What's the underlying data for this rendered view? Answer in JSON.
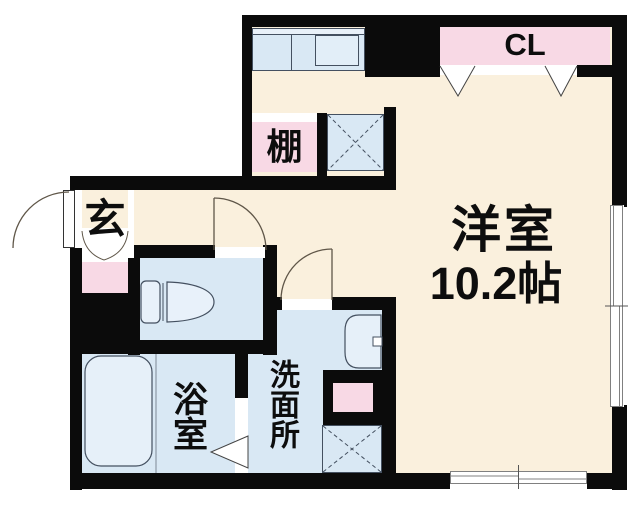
{
  "labels": {
    "closet": "CL",
    "shelf": "棚",
    "entrance": "玄",
    "main_room_name": "洋室",
    "main_room_size": "10.2帖",
    "bathroom": "浴室",
    "washroom": "洗面所"
  },
  "colors": {
    "wall": "#0b0b0b",
    "floor": "#faf0dd",
    "wet_area": "#d9e8f4",
    "accent_pink": "#f8d9e5",
    "fixture_fill": "#e7f0f9",
    "window_frame": "#808080",
    "door_arc": "#5f5648"
  },
  "fixtures": [
    "kitchen-counter",
    "kitchen-sink",
    "closet-bifold-doors",
    "shelf",
    "storage-cross-box-upper",
    "entrance-door",
    "toilet",
    "bathtub",
    "washbasin",
    "washing-machine-space",
    "sliding-window-right",
    "sliding-window-bottom"
  ]
}
